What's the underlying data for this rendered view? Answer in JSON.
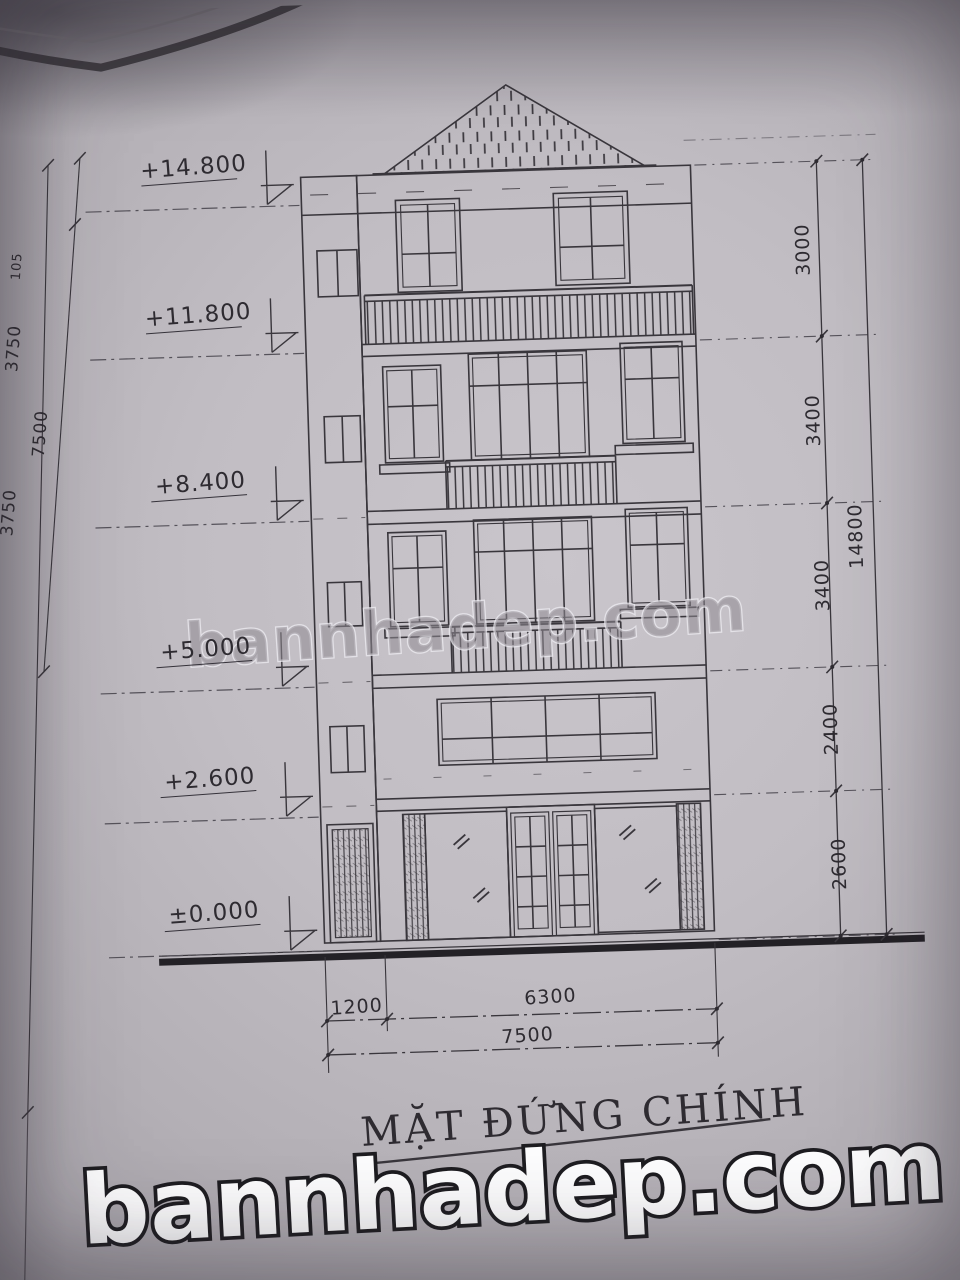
{
  "title": "MẶT ĐỨNG CHÍNH",
  "watermarks": {
    "center": "bannhadep.com",
    "bottom": "bannhadep.com"
  },
  "elevation_markers": [
    "+14.800",
    "+11.800",
    "+8.400",
    "+5.000",
    "+2.600",
    "±0.000"
  ],
  "left_dims": [
    "105",
    "3750",
    "7500",
    "3750"
  ],
  "right_dims": [
    "3000",
    "3400",
    "3400",
    "2400",
    "2600"
  ],
  "right_total_dim": "14800",
  "bottom_dims": [
    "1200",
    "6300"
  ],
  "bottom_total_dim": "7500",
  "drawing_colors": {
    "line": "#39363c",
    "heavy_line": "#232126",
    "paper": "#c0bcc2"
  }
}
